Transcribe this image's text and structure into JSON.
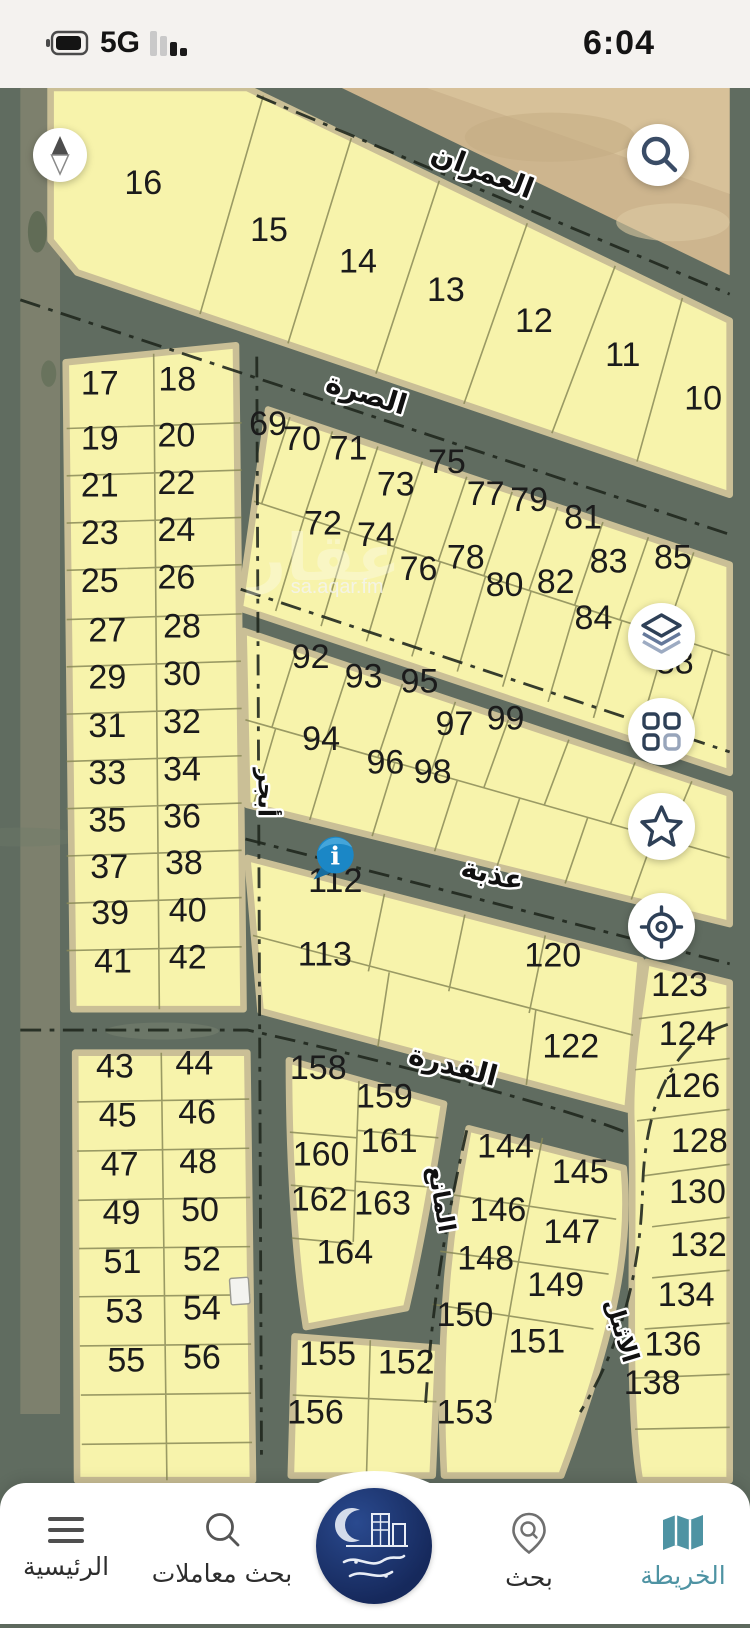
{
  "status_bar": {
    "time": "6:04",
    "network": "5G",
    "icons": [
      "battery-icon",
      "signal-bars-icon"
    ]
  },
  "map": {
    "colors": {
      "plot_fill": "#f7f3ab",
      "road": "#606c60",
      "desert": "#cdb58e",
      "pin_blue": "#1b87c6",
      "icon_navy": "#2e4057",
      "accent_teal": "#4e93a3"
    },
    "watermark": {
      "site": "sa.aqar.fm",
      "mark": "عقار"
    },
    "info_marker": {
      "glyph": "i"
    },
    "streets": [
      [
        "العمران",
        485,
        185,
        21,
        30
      ],
      [
        "الصرة",
        363,
        421,
        17,
        30
      ],
      [
        "عذبة",
        497,
        929,
        14,
        30
      ],
      [
        "القدرة",
        455,
        1131,
        15,
        30
      ],
      [
        "أبجر",
        252,
        833,
        90,
        25
      ],
      [
        "المانع",
        437,
        1264,
        80,
        25
      ],
      [
        "الاثبل",
        628,
        1404,
        73,
        25
      ]
    ],
    "plots": [
      [
        16,
        130,
        200,
        44
      ],
      [
        15,
        263,
        250,
        44
      ],
      [
        14,
        357,
        283,
        44
      ],
      [
        13,
        450,
        313,
        44
      ],
      [
        12,
        543,
        346,
        44
      ],
      [
        11,
        637,
        382,
        44
      ],
      [
        10,
        722,
        428,
        44
      ],
      [
        17,
        84,
        412,
        38
      ],
      [
        18,
        166,
        408,
        38
      ],
      [
        19,
        84,
        470,
        38
      ],
      [
        20,
        165,
        467,
        38
      ],
      [
        21,
        84,
        520,
        38
      ],
      [
        22,
        165,
        517,
        38
      ],
      [
        23,
        84,
        570,
        38
      ],
      [
        24,
        165,
        567,
        38
      ],
      [
        25,
        84,
        621,
        38
      ],
      [
        26,
        165,
        617,
        38
      ],
      [
        27,
        92,
        673,
        38
      ],
      [
        28,
        171,
        669,
        38
      ],
      [
        29,
        92,
        723,
        38
      ],
      [
        30,
        171,
        719,
        38
      ],
      [
        31,
        92,
        774,
        38
      ],
      [
        32,
        171,
        770,
        38
      ],
      [
        33,
        92,
        824,
        38
      ],
      [
        34,
        171,
        820,
        38
      ],
      [
        35,
        92,
        874,
        38
      ],
      [
        36,
        171,
        870,
        38
      ],
      [
        37,
        94,
        923,
        38
      ],
      [
        38,
        173,
        919,
        38
      ],
      [
        39,
        95,
        972,
        38
      ],
      [
        40,
        177,
        969,
        38
      ],
      [
        41,
        98,
        1023,
        38
      ],
      [
        42,
        177,
        1019,
        38
      ],
      [
        43,
        100,
        1134,
        38
      ],
      [
        44,
        184,
        1131,
        38
      ],
      [
        45,
        103,
        1186,
        38
      ],
      [
        46,
        187,
        1183,
        38
      ],
      [
        47,
        105,
        1238,
        38
      ],
      [
        48,
        188,
        1235,
        38
      ],
      [
        49,
        107,
        1289,
        38
      ],
      [
        50,
        190,
        1286,
        38
      ],
      [
        51,
        108,
        1341,
        38
      ],
      [
        52,
        192,
        1338,
        38
      ],
      [
        53,
        110,
        1393,
        38
      ],
      [
        54,
        192,
        1390,
        38
      ],
      [
        55,
        112,
        1445,
        38
      ],
      [
        56,
        192,
        1442,
        38
      ],
      [
        69,
        262,
        455,
        37
      ],
      [
        70,
        298,
        471,
        37
      ],
      [
        71,
        347,
        481,
        37
      ],
      [
        73,
        397,
        519,
        37
      ],
      [
        75,
        451,
        495,
        37
      ],
      [
        77,
        492,
        529,
        37
      ],
      [
        79,
        538,
        535,
        37
      ],
      [
        81,
        595,
        554,
        37
      ],
      [
        83,
        622,
        600,
        37
      ],
      [
        85,
        690,
        596,
        37
      ],
      [
        72,
        320,
        560,
        37
      ],
      [
        74,
        376,
        572,
        37
      ],
      [
        76,
        421,
        608,
        37
      ],
      [
        78,
        471,
        596,
        37
      ],
      [
        80,
        512,
        625,
        37
      ],
      [
        82,
        566,
        622,
        37
      ],
      [
        84,
        606,
        660,
        37
      ],
      [
        88,
        692,
        707,
        37
      ],
      [
        92,
        307,
        701,
        37
      ],
      [
        93,
        363,
        722,
        37
      ],
      [
        95,
        422,
        727,
        37
      ],
      [
        97,
        459,
        772,
        37
      ],
      [
        99,
        513,
        766,
        37
      ],
      [
        94,
        318,
        788,
        37
      ],
      [
        96,
        386,
        813,
        37
      ],
      [
        98,
        436,
        823,
        37
      ],
      [
        112,
        333,
        938,
        37
      ],
      [
        113,
        322,
        1016,
        37
      ],
      [
        120,
        563,
        1017,
        37
      ],
      [
        122,
        582,
        1113,
        37
      ],
      [
        123,
        697,
        1048,
        36
      ],
      [
        124,
        705,
        1100,
        36
      ],
      [
        126,
        710,
        1155,
        36
      ],
      [
        128,
        718,
        1213,
        36
      ],
      [
        130,
        716,
        1267,
        36
      ],
      [
        132,
        717,
        1323,
        36
      ],
      [
        134,
        704,
        1376,
        36
      ],
      [
        136,
        690,
        1428,
        36
      ],
      [
        138,
        668,
        1469,
        36
      ],
      [
        158,
        315,
        1136,
        34
      ],
      [
        159,
        385,
        1166,
        34
      ],
      [
        160,
        318,
        1227,
        34
      ],
      [
        161,
        390,
        1213,
        34
      ],
      [
        162,
        316,
        1275,
        34
      ],
      [
        163,
        383,
        1279,
        34
      ],
      [
        164,
        343,
        1331,
        34
      ],
      [
        144,
        513,
        1219,
        34
      ],
      [
        145,
        592,
        1246,
        34
      ],
      [
        146,
        505,
        1286,
        34
      ],
      [
        147,
        583,
        1309,
        34
      ],
      [
        148,
        492,
        1337,
        34
      ],
      [
        149,
        566,
        1365,
        34
      ],
      [
        150,
        470,
        1397,
        34
      ],
      [
        151,
        546,
        1425,
        34
      ],
      [
        155,
        325,
        1438,
        34
      ],
      [
        152,
        408,
        1447,
        34
      ],
      [
        156,
        312,
        1500,
        34
      ],
      [
        153,
        470,
        1500,
        34
      ]
    ]
  },
  "map_buttons": [
    "compass",
    "search",
    "layers",
    "categories",
    "favorites",
    "my-location"
  ],
  "bottom_nav": {
    "items": [
      {
        "id": "home",
        "label": "الرئيسية"
      },
      {
        "id": "deals-search",
        "label": "بحث معاملات"
      },
      {
        "id": "brand-logo",
        "label": ""
      },
      {
        "id": "search",
        "label": "بحث"
      },
      {
        "id": "map",
        "label": "الخريطة"
      }
    ],
    "active": "الخريطة"
  }
}
